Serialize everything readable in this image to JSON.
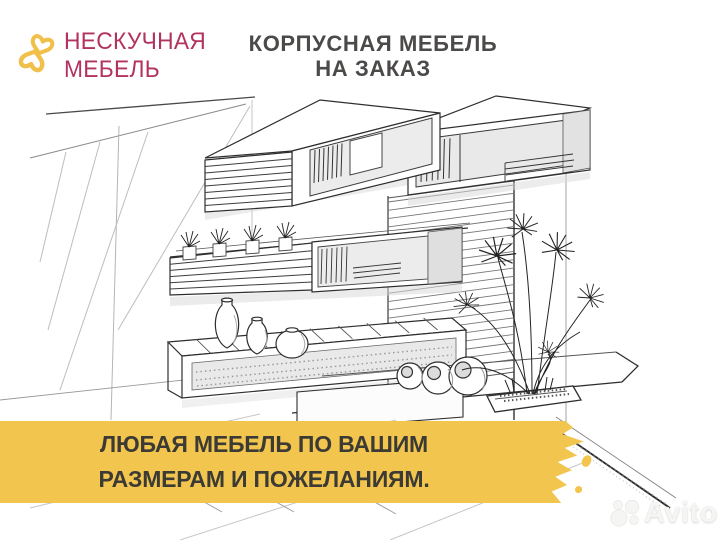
{
  "logo": {
    "line1": "НЕСКУЧНАЯ",
    "line2": "МЕБЕЛЬ",
    "text_color": "#b23260",
    "icon": "double-heart-monogram-icon",
    "icon_color": "#f1c04b"
  },
  "header": {
    "line1": "КОРПУСНАЯ МЕБЕЛЬ",
    "line2": "НА ЗАКАЗ",
    "color": "#4b4a48"
  },
  "banner": {
    "line1": "ЛЮБАЯ МЕБЕЛЬ ПО ВАШИМ",
    "line2": "РАЗМЕРАМ И ПОЖЕЛАНИЯМ.",
    "bg_color": "#f2c54e",
    "text_color": "#3c3a34"
  },
  "watermark": {
    "label": "Avito"
  }
}
